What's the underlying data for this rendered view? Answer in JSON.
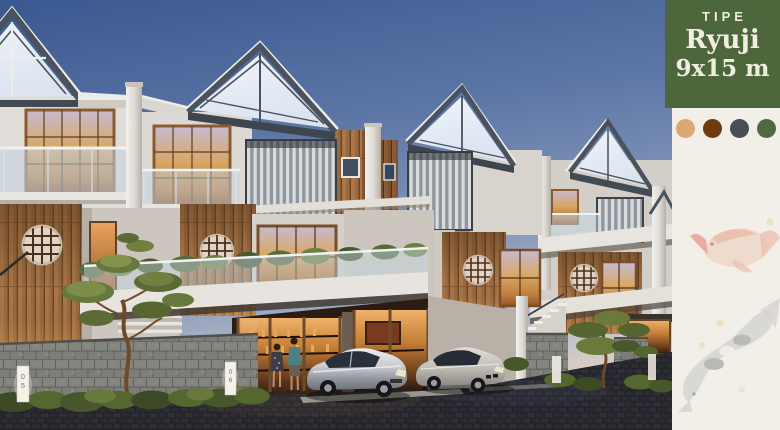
{
  "panel": {
    "type_label": "TIPE",
    "type_name": "Ryuji",
    "type_size": "9x15 m",
    "colors": {
      "card_green": "#4E663B",
      "card_text": "#F2EDE1",
      "panel_cream": "#F2EFE8"
    },
    "swatches": [
      {
        "name": "sand",
        "color": "#D9A873"
      },
      {
        "name": "dark-brown",
        "color": "#6E3A10"
      },
      {
        "name": "charcoal",
        "color": "#4B4F55"
      },
      {
        "name": "olive",
        "color": "#4E6B3F"
      }
    ]
  },
  "scene": {
    "unit_markers": [
      {
        "d1": "0",
        "d2": "5"
      },
      {
        "d1": "0",
        "d2": "6"
      }
    ],
    "colors": {
      "sky_top": "#3A5890",
      "sky_horizon": "#D6CCC5",
      "wood": "#9A6A3E",
      "window_glow": "#D9A868",
      "roof_trim": "#49525D",
      "stone_fence": "#7E7E79",
      "pavement": "#232329"
    }
  }
}
